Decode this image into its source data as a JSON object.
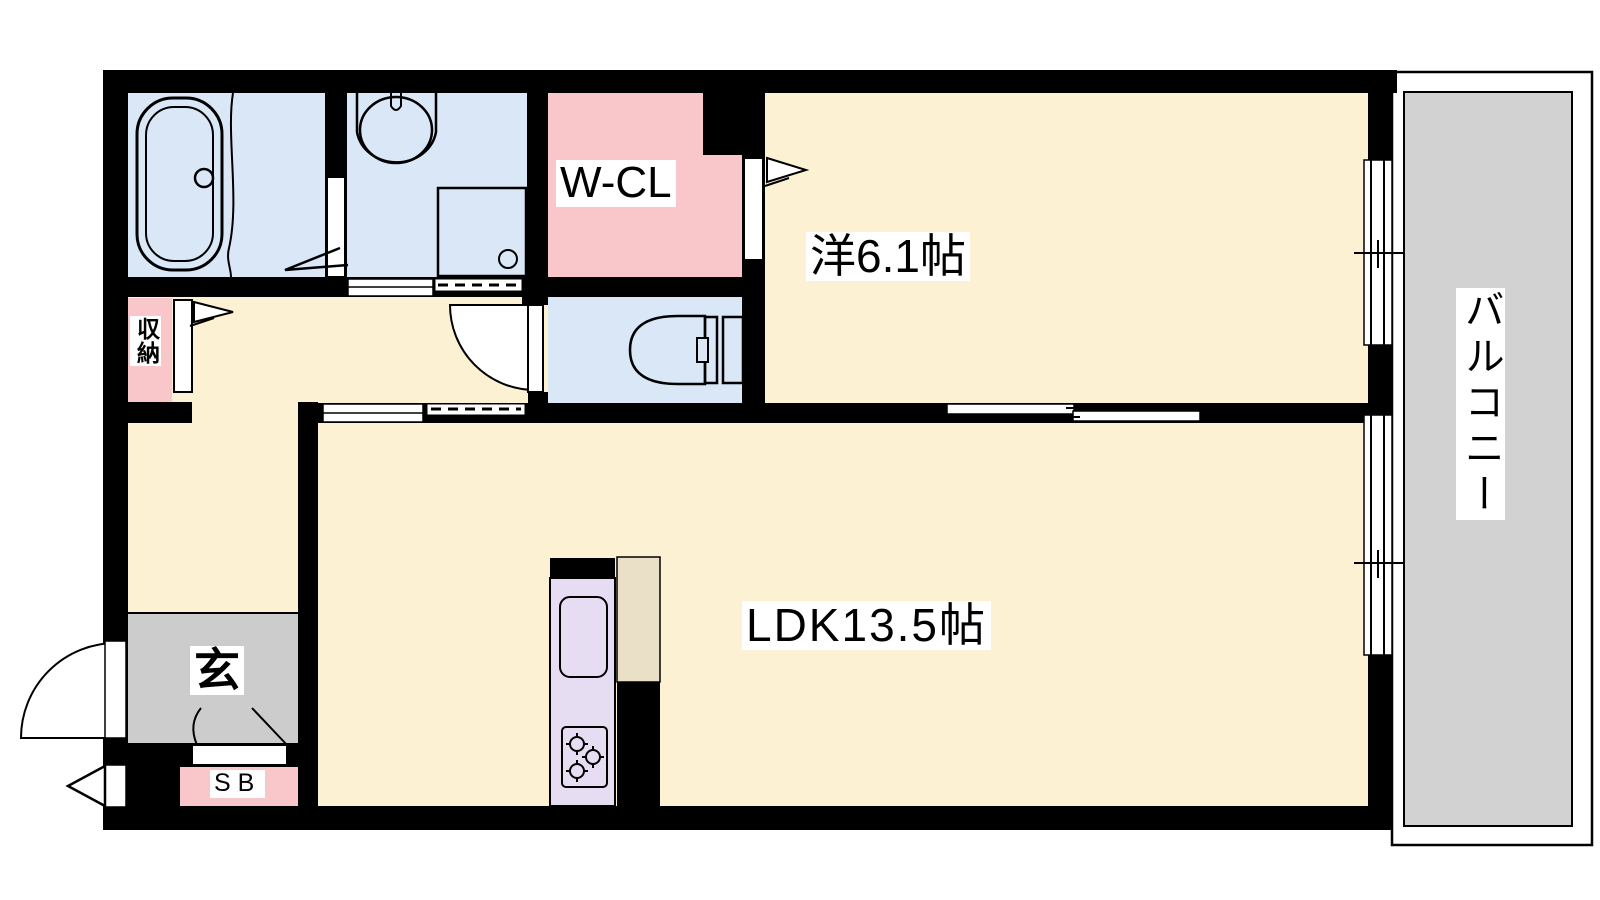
{
  "document": {
    "type": "apartment-floor-plan",
    "layout_name": "1LDK"
  },
  "colors": {
    "floor_cream": "#fdf1d4",
    "wet_area_blue": "#d9e7f7",
    "closet_pink": "#f9c6ca",
    "balcony_gray": "#d2d2d2",
    "entrance_gray": "#cccccc",
    "kitchen_lavender": "#e7ddf3",
    "appliance_beige": "#eae0c8",
    "wall_black": "#000000"
  },
  "rooms": {
    "western_room": {
      "label": "洋6.1帖"
    },
    "ldk": {
      "label": "LDK13.5帖"
    },
    "balcony": {
      "label": "バルコニー"
    },
    "walk_in_closet": {
      "label": "W-CL"
    },
    "entrance": {
      "label": "玄"
    },
    "shoe_box": {
      "label": "SB"
    },
    "storage": {
      "label": "収納"
    }
  }
}
